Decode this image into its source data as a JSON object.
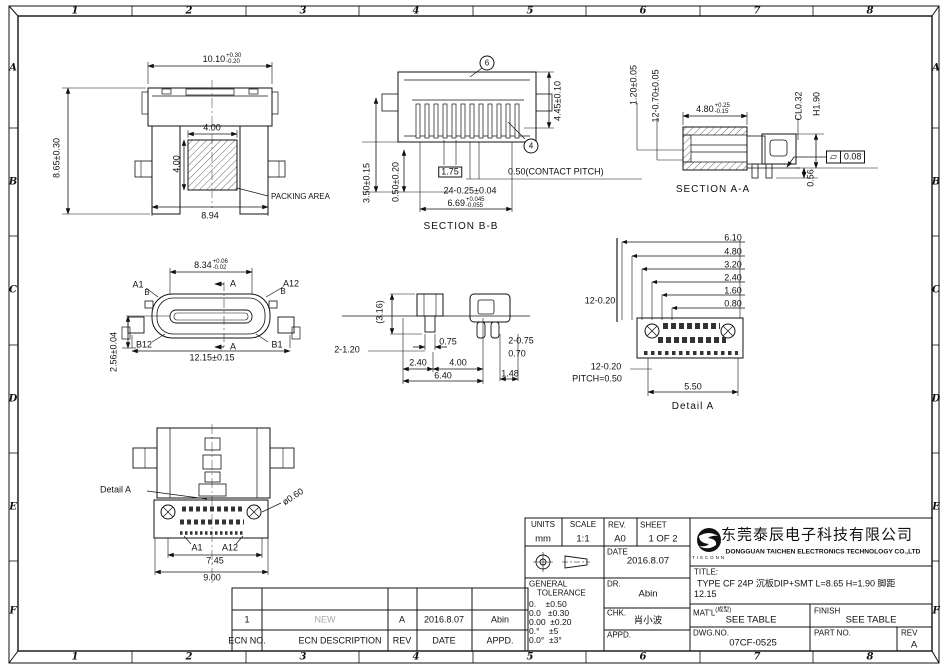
{
  "border": {
    "cols": [
      "1",
      "2",
      "3",
      "4",
      "5",
      "6",
      "7",
      "8"
    ],
    "rows": [
      "A",
      "B",
      "C",
      "D",
      "E",
      "F"
    ]
  },
  "views": {
    "packing": {
      "dim_width": "10.10",
      "dim_width_plus": "+0.30",
      "dim_width_minus": "-0.20",
      "dim_height": "8.65±0.30",
      "dim_sq_w": "4.00",
      "dim_sq_h": "4.00",
      "packing_label": "PACKING AREA",
      "dim_bottom": "8.94"
    },
    "section_bb": {
      "label": "SECTION B-B",
      "balloon_top": "6",
      "balloon_right": "4",
      "dim_height": "4.45±0.10",
      "dim_left_outer": "3.50±0.15",
      "dim_left_inner": "0.50±0.20",
      "dim_boxed": "1.75",
      "dim_pitch": "0.50(CONTACT PITCH)",
      "dim_contacts": "24-0.25±0.04",
      "dim_tongue": "6.69",
      "dim_tongue_plus": "+0.045",
      "dim_tongue_minus": "-0.055"
    },
    "section_aa": {
      "label": "SECTION A-A",
      "dim_row1": "1.20±0.05",
      "dim_row2": "12-0.70±0.05",
      "dim_depth": "4.80",
      "dim_depth_plus": "+0.25",
      "dim_depth_minus": "-0.15",
      "dim_c": "CL0.32",
      "dim_h": "H1.90",
      "dim_standoff": "0.56",
      "flatness_value": "0.08"
    },
    "front": {
      "dim_tongue": "8.34",
      "dim_tongue_plus": "+0.06",
      "dim_tongue_minus": "-0.02",
      "pin_a1": "A1",
      "pin_a12": "A12",
      "b_left": "B",
      "b_right": "B",
      "pin_b12": "B12",
      "pin_b1": "B1",
      "cut_top": "A",
      "cut_bottom": "A",
      "dim_width": "12.15±0.15",
      "dim_height": "2.56±0.04"
    },
    "side": {
      "dim_ref": "(3.16)",
      "dim_legs": "2-1.20",
      "dim_075": "0.75",
      "dim_2075": "2-0.75",
      "dim_070": "0.70",
      "dim_240": "2.40",
      "dim_400": "4.00",
      "dim_640": "6.40",
      "dim_148": "1.48"
    },
    "detail_a": {
      "label": "Detail A",
      "stack": [
        "6.10",
        "4.80",
        "3.20",
        "2.40",
        "1.60",
        "0.80"
      ],
      "dim_pins_top": "12-0.20",
      "dim_pins_bottom": "12-0.20",
      "pitch": "PITCH=0.50",
      "dim_550": "5.50"
    },
    "bottom": {
      "detail_label": "Detail A",
      "dim_hole": "ø0.60",
      "pin_a1": "A1",
      "pin_a12": "A12",
      "dim_745": "7.45",
      "dim_900": "9.00"
    }
  },
  "ecn": {
    "headers": {
      "no": "ECN NO.",
      "desc": "ECN  DESCRIPTION",
      "rev": "REV",
      "date": "DATE",
      "appd": "APPD."
    },
    "row": {
      "no": "1",
      "desc": "NEW",
      "rev": "A",
      "date": "2016.8.07",
      "appd": "Abin"
    }
  },
  "title_block": {
    "units_label": "UNITS",
    "units_value": "mm",
    "scale_label": "SCALE",
    "scale_value": "1:1",
    "rev_label": "REV.",
    "rev_value": "A0",
    "sheet_label": "SHEET",
    "sheet_value": "1 OF 2",
    "date_label": "DATE",
    "date_value": "2016.8.07",
    "dr_label": "DR.",
    "dr_value": "Abin",
    "chk_label": "CHK.",
    "chk_value": "肖小波",
    "appd_label": "APPD.",
    "appd_value": "",
    "tolerance_title_1": "GENERAL",
    "tolerance_title_2": "TOLERANCE",
    "tolerance_rows": [
      "0.    ±0.50",
      "0.0   ±0.30",
      "0.00  ±0.20",
      "0.°    ±5",
      "0.0°  ±3°"
    ],
    "company_cn": "东莞泰辰电子科技有限公司",
    "company_en": "DONGGUAN TAICHEN ELECTRONICS TECHNOLOGY CO.,LTD",
    "logo_text": "TISCONN",
    "title_label": "TITLE:",
    "title_line1": "TYPE CF 24P 沉板DIP+SMT L=8.65 H=1.90 脚距",
    "title_line2": "12.15",
    "matl_label": "MAT'L",
    "matl_note": "(成型)",
    "matl_value": "SEE TABLE",
    "finish_label": "FINISH",
    "finish_value": "SEE TABLE",
    "dwg_label": "DWG.NO.",
    "dwg_value": "07CF-0525",
    "part_label": "PART NO.",
    "part_value": "",
    "rev_col_label": "REV",
    "rev_col_value": "A"
  }
}
